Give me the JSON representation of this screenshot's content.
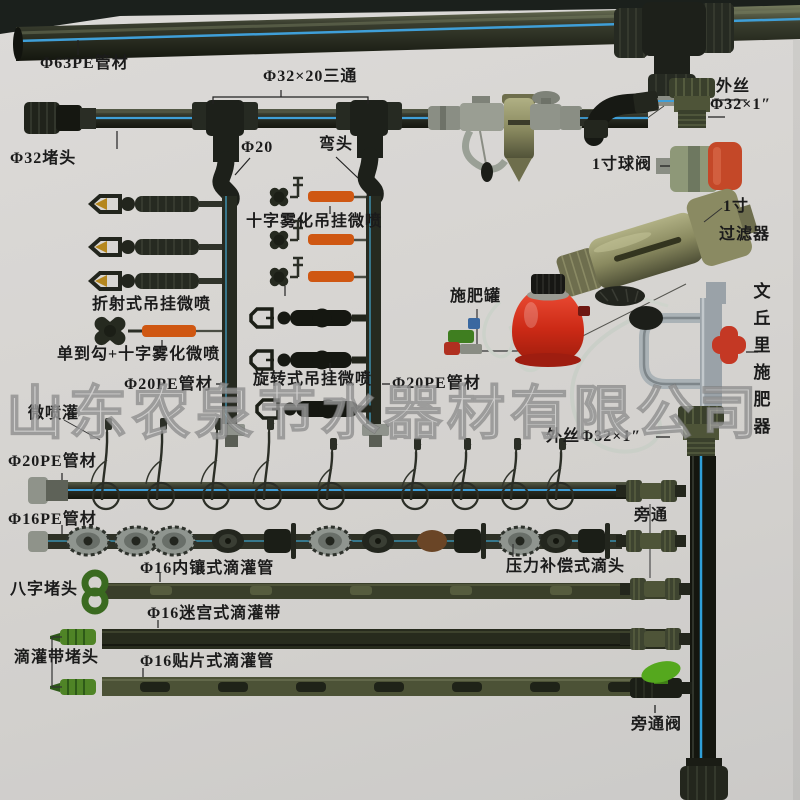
{
  "watermark": {
    "text": "山东农泉节水器材有限公司"
  },
  "labels": {
    "phi63_pipe": "Φ63PE管材",
    "tee_32x20": "Φ32×20三通",
    "phi32_plug": "Φ32堵头",
    "phi20": "Φ20",
    "elbow": "弯头",
    "male_adapter_top_line1": "外丝",
    "male_adapter_top_line2": "Φ32×1″",
    "ball_valve_1inch": "1寸球阀",
    "cross_atomizer_hanging": "十字雾化吊挂微喷",
    "filter_1inch_line1": "1寸",
    "filter_1inch_line2": "过滤器",
    "refraction_hanging_sprayer": "折射式吊挂微喷",
    "fertilizer_tank": "施肥罐",
    "venturi_fertilizer_injector": "文丘里施肥器",
    "single_hook_cross_atomizer": "单到勾+十字雾化微喷",
    "rotary_hanging_sprayer": "旋转式吊挂微喷",
    "phi20_pipe_left": "Φ20PE管材",
    "phi20_pipe_right": "Φ20PE管材",
    "micro_sprinkler": "微喷灌",
    "male_adapter_mid": "外丝Φ32×1″",
    "phi20_pipe_row": "Φ20PE管材",
    "phi16_pipe_row": "Φ16PE管材",
    "bypass": "旁通",
    "inline_drip_pipe": "Φ16内镶式滴灌管",
    "pressure_comp_dripper": "压力补偿式滴头",
    "figure8_plug": "八字堵头",
    "maze_drip_tape": "Φ16迷宫式滴灌带",
    "drip_tape_plug": "滴灌带堵头",
    "patch_drip_pipe": "Φ16贴片式滴灌管",
    "bypass_valve": "旁通阀"
  },
  "colors": {
    "paper": "#d7d5d2",
    "pipe_dark": "#22251d",
    "stripe_blue": "#3f9fd8",
    "orange_nozzle_tube": "#cf5712",
    "tank_red": "#cc2a16",
    "valve_handle_orange": "#c44828",
    "venturi_handle_red": "#c43824",
    "bypass_valve_green": "#55a81e",
    "plug_green": "#4f8426",
    "olive_fitting": "#4e5438",
    "brass_filter": "#8a8a60",
    "gray_pvc": "#9aa2a8"
  }
}
